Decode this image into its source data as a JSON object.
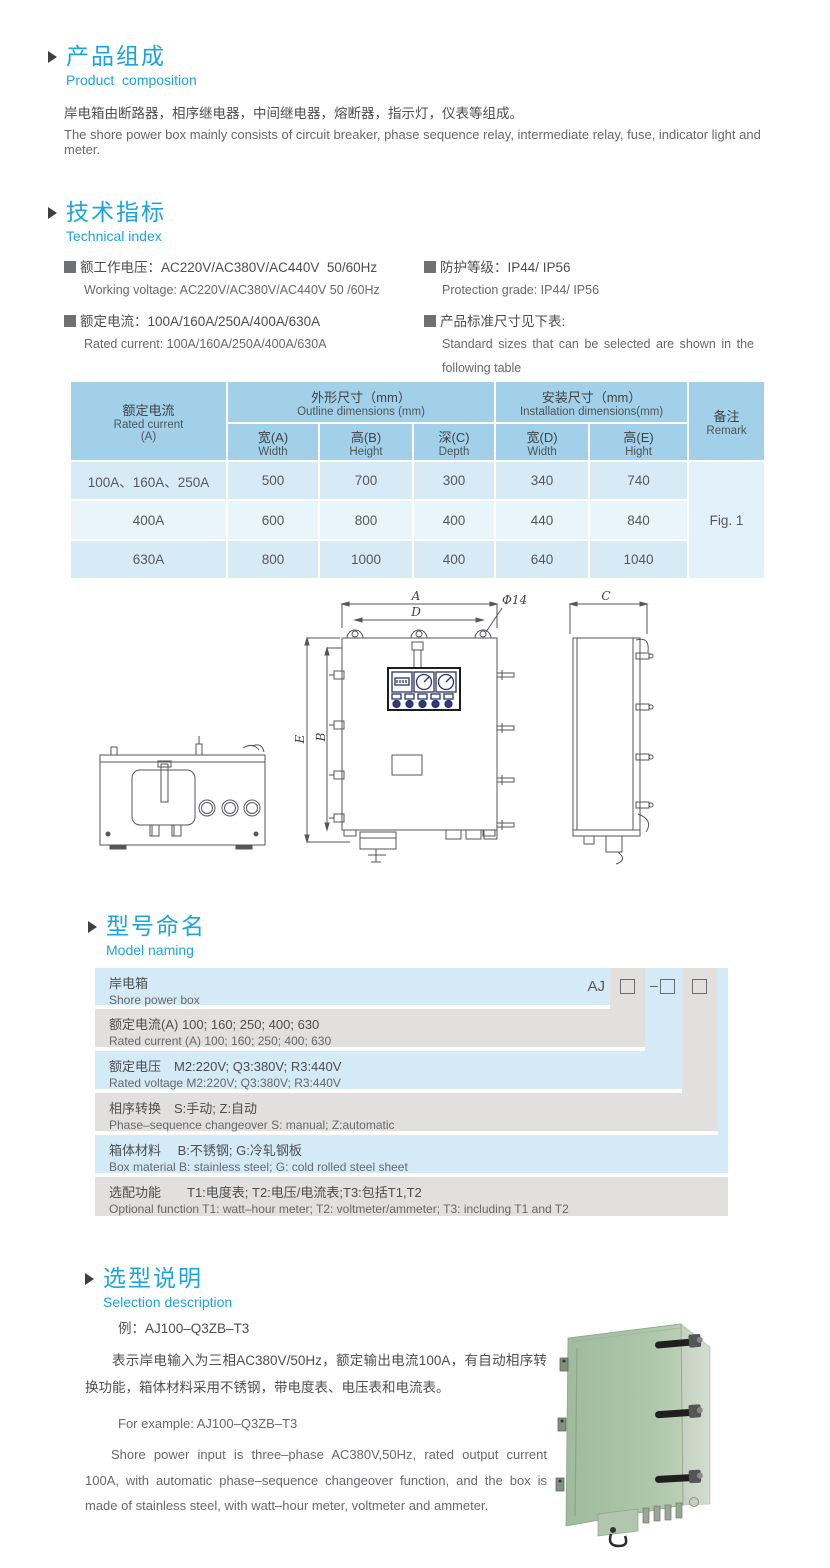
{
  "colors": {
    "accent_blue": "#1ba4de",
    "table_header_bg": "#a2d0e9",
    "table_row_dark": "#d7ebf7",
    "table_row_light": "#e9f4fb",
    "naming_blue": "#d5eaf7",
    "naming_gray": "#e2e0de",
    "box_green": "#a8c2a6"
  },
  "composition": {
    "title_zh": "产品组成",
    "title_en": "Product  composition",
    "body_zh": "岸电箱由断路器，相序继电器，中间继电器，熔断器，指示灯，仪表等组成。",
    "body_en": "The shore power box mainly consists of circuit breaker, phase sequence relay, intermediate relay, fuse, indicator light and meter."
  },
  "technical": {
    "title_zh": "技术指标",
    "title_en": "Technical index",
    "specs": [
      {
        "zh": "额工作电压：AC220V/AC380V/AC440V  50/60Hz",
        "en": "Working voltage: AC220V/AC380V/AC440V 50 /60Hz"
      },
      {
        "zh": "额定电流：100A/160A/250A/400A/630A",
        "en": "Rated current: 100A/160A/250A/400A/630A"
      },
      {
        "zh": "防护等级：IP44/ IP56",
        "en": "Protection grade: IP44/ IP56"
      },
      {
        "zh": "产品标准尺寸见下表:",
        "en": "Standard sizes that can be selected are shown in the following table"
      }
    ]
  },
  "dim_table": {
    "rated_current_zh": "额定电流",
    "rated_current_en": "Rated current",
    "rated_current_unit": "(A)",
    "outline_zh": "外形尺寸（mm）",
    "outline_en": "Outline dimensions (mm)",
    "install_zh": "安装尺寸（mm）",
    "install_en": "Installation dimensions(mm)",
    "remark_zh": "备注",
    "remark_en": "Remark",
    "cols": [
      {
        "zh": "宽(A)",
        "en": "Width"
      },
      {
        "zh": "高(B)",
        "en": "Height"
      },
      {
        "zh": "深(C)",
        "en": "Depth"
      },
      {
        "zh": "宽(D)",
        "en": "Width"
      },
      {
        "zh": "高(E)",
        "en": "Hight"
      }
    ],
    "rows": [
      {
        "label": "100A、160A、250A",
        "w": "500",
        "h": "700",
        "d": "300",
        "iw": "340",
        "ih": "740"
      },
      {
        "label": "400A",
        "w": "600",
        "h": "800",
        "d": "400",
        "iw": "440",
        "ih": "840"
      },
      {
        "label": "630A",
        "w": "800",
        "h": "1000",
        "d": "400",
        "iw": "640",
        "ih": "1040"
      }
    ],
    "remark_value": "Fig. 1"
  },
  "drawing": {
    "labels": {
      "a": "A",
      "b": "B",
      "c": "C",
      "d": "D",
      "e": "E",
      "phi": "Φ14"
    }
  },
  "naming": {
    "title_zh": "型号命名",
    "title_en": "Model naming",
    "prefix": "AJ",
    "dash": "–",
    "rows": [
      {
        "zh": "岸电箱",
        "en": "Shore power box"
      },
      {
        "zh": "额定电流(A)  100; 160; 250; 400; 630",
        "en": "Rated current (A) 100; 160; 250; 400; 630"
      },
      {
        "zh": "额定电压　M2:220V;  Q3:380V;  R3:440V",
        "en": "Rated voltage  M2:220V;  Q3:380V;  R3:440V"
      },
      {
        "zh": "相序转换　S:手动; Z:自动",
        "en": "Phase–sequence changeover  S: manual;  Z:automatic"
      },
      {
        "zh": "箱体材料　 B:不锈钢;  G:冷轧钢板",
        "en": "Box material   B: stainless steel; G: cold rolled steel sheet"
      },
      {
        "zh": "选配功能　　T1:电度表;  T2:电压/电流表;T3:包括T1,T2",
        "en": "Optional function  T1: watt–hour meter; T2: voltmeter/ammeter; T3: including T1 and T2"
      }
    ]
  },
  "selection": {
    "title_zh": "选型说明",
    "title_en": "Selection description",
    "example_zh": "例：AJ100–Q3ZB–T3",
    "desc_zh": "表示岸电输入为三相AC380V/50Hz，额定输出电流100A，有自动相序转换功能，箱体材料采用不锈钢，带电度表、电压表和电流表。",
    "example_en": "For example: AJ100–Q3ZB–T3",
    "desc_en": "Shore power input is three–phase AC380V,50Hz, rated output current 100A, with automatic phase–sequence changeover function, and the box is made of stainless steel, with watt–hour meter, voltmeter and ammeter."
  }
}
